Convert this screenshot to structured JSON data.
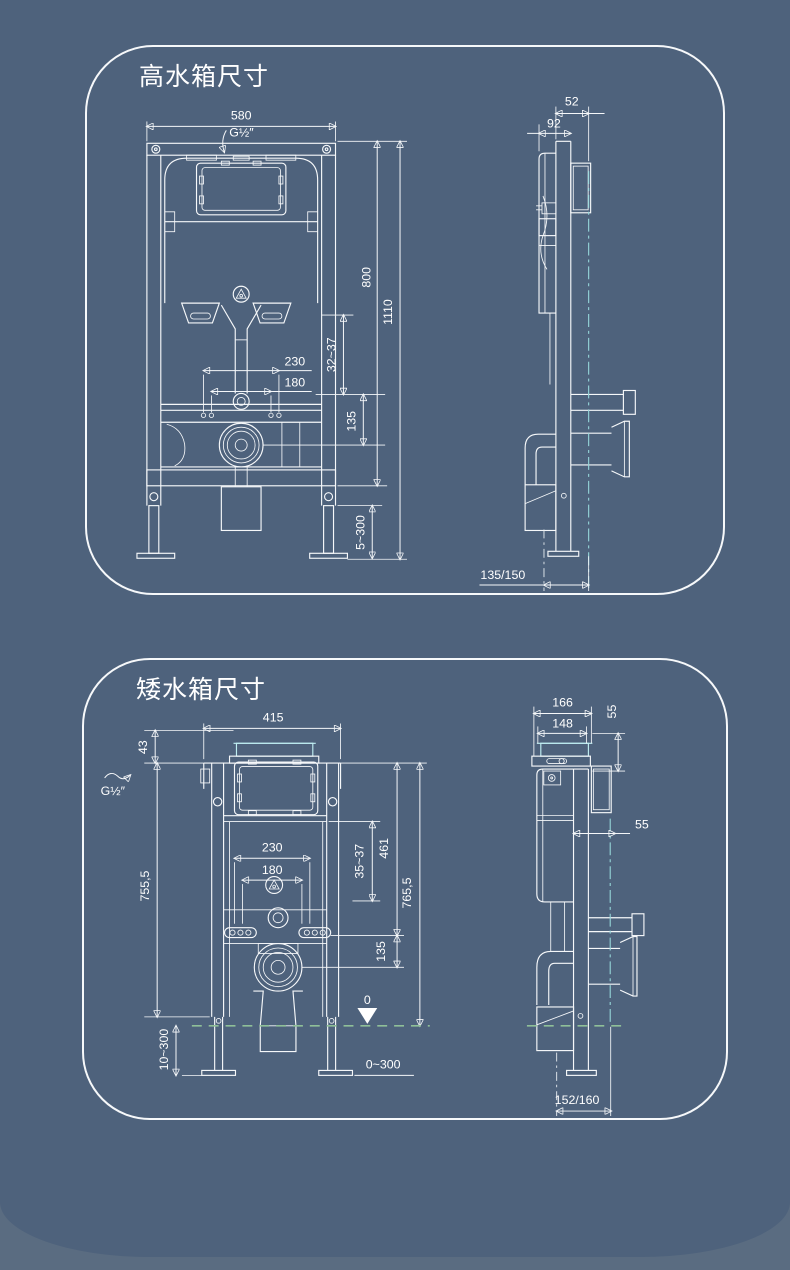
{
  "page": {
    "background": "#5a6c81",
    "card_color": "#4e627c",
    "line_color": "#ffffff",
    "accent_teal": "#55cfe0",
    "accent_green": "#8fbf98"
  },
  "high_tank": {
    "title": "高水箱尺寸",
    "front": {
      "width_top": "580",
      "inlet": "G½″",
      "frame_height": "800",
      "total_height": "1110",
      "bolt_spacing_outer": "230",
      "bolt_spacing_inner": "180",
      "wall_range": "32~37",
      "outlet_height": "135",
      "leg_adjust": "5~300"
    },
    "side": {
      "depth_plate": "52",
      "depth_body": "92",
      "outlet_offset": "135/150"
    }
  },
  "low_tank": {
    "title": "矮水箱尺寸",
    "front": {
      "width_top": "415",
      "cap_height": "43",
      "inlet": "G½″",
      "left_height": "755,5",
      "inner_height": "461",
      "wall_range": "35~37",
      "total_height": "765,5",
      "outlet_height": "135",
      "bolt_spacing_outer": "230",
      "bolt_spacing_inner": "180",
      "leg_adjust": "10~300",
      "floor_range": "0~300",
      "level_mark": "0"
    },
    "side": {
      "depth_total": "166",
      "depth_body": "148",
      "cap_depth": "55",
      "wall_offset": "55",
      "outlet_offset": "152/160"
    }
  }
}
